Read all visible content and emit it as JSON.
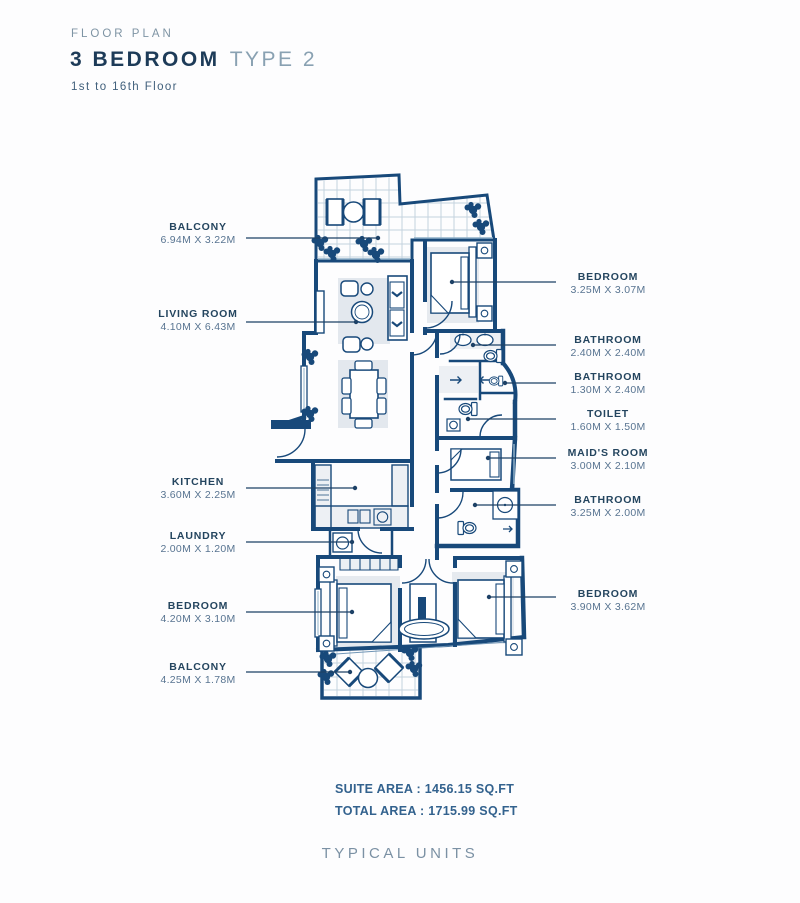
{
  "header": {
    "eyebrow": "FLOOR PLAN",
    "title_bold": "3 BEDROOM",
    "title_light": "TYPE 2",
    "subtitle": "1st to 16th Floor"
  },
  "rooms_left": [
    {
      "name": "BALCONY",
      "dims": "6.94M X 3.22M"
    },
    {
      "name": "LIVING ROOM",
      "dims": "4.10M X 6.43M"
    },
    {
      "name": "KITCHEN",
      "dims": "3.60M X 2.25M"
    },
    {
      "name": "LAUNDRY",
      "dims": "2.00M X 1.20M"
    },
    {
      "name": "BEDROOM",
      "dims": "4.20M X 3.10M"
    },
    {
      "name": "BALCONY",
      "dims": "4.25M X 1.78M"
    }
  ],
  "rooms_right": [
    {
      "name": "BEDROOM",
      "dims": "3.25M X 3.07M"
    },
    {
      "name": "BATHROOM",
      "dims": "2.40M X 2.40M"
    },
    {
      "name": "BATHROOM",
      "dims": "1.30M X 2.40M"
    },
    {
      "name": "TOILET",
      "dims": "1.60M X 1.50M"
    },
    {
      "name": "MAID'S ROOM",
      "dims": "3.00M X 2.10M"
    },
    {
      "name": "BATHROOM",
      "dims": "3.25M X 2.00M"
    },
    {
      "name": "BEDROOM",
      "dims": "3.90M X 3.62M"
    }
  ],
  "areas": {
    "suite": "SUITE AREA : 1456.15 SQ.FT",
    "total": "TOTAL AREA : 1715.99 SQ.FT"
  },
  "footer": {
    "label": "TYPICAL UNITS"
  },
  "colors": {
    "wall": "#18497a",
    "label_dark": "#24455f",
    "label_dim": "#587491",
    "accent_light": "#89a1b2",
    "rug": "#e3e8ee",
    "tile_line": "#c3d2de"
  }
}
